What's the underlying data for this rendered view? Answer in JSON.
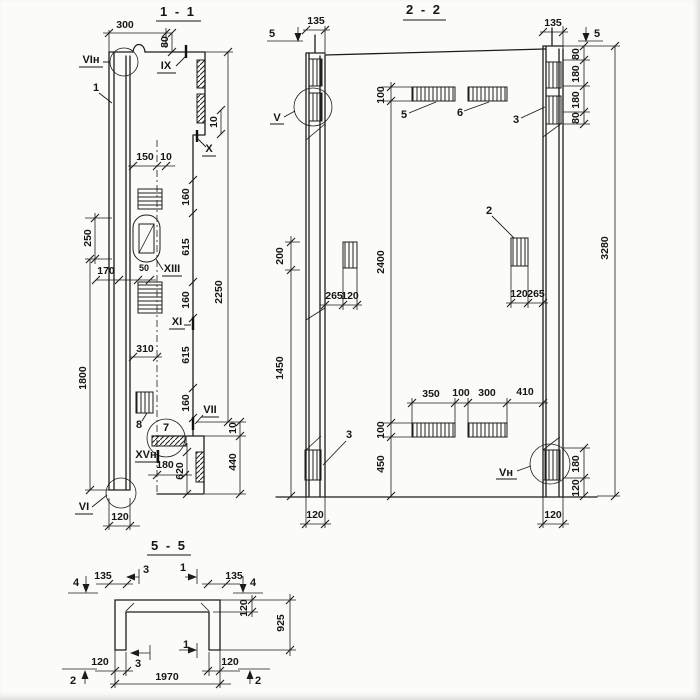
{
  "s11": {
    "title": "1 - 1",
    "dims": {
      "d300": "300",
      "d80": "80",
      "d150": "150",
      "d10a": "10",
      "d10b": "10",
      "d10c": "10",
      "d160a": "160",
      "d615a": "615",
      "d160b": "160",
      "d615b": "615",
      "d160c": "160",
      "d2250": "2250",
      "d250": "250",
      "d170": "170",
      "d50": "50",
      "d310": "310",
      "d1800": "1800",
      "d180": "180",
      "d620": "620",
      "d440": "440",
      "d120": "120"
    },
    "marks": {
      "vi_n": "VIн",
      "one": "1",
      "ix": "IX",
      "x": "X",
      "xiii": "XIII",
      "xi": "XI",
      "vii": "VII",
      "xv_n": "XVн",
      "vi": "VI",
      "seven": "7",
      "eight": "8"
    }
  },
  "s22": {
    "title": "2 - 2",
    "dims": {
      "d135l": "135",
      "d135r": "135",
      "d100t": "100",
      "d2400": "2400",
      "d100b": "100",
      "d450": "450",
      "d200": "200",
      "d1450": "1450",
      "d265l": "265",
      "d120l": "120",
      "d120r": "120",
      "d265r": "265",
      "d350": "350",
      "d100m": "100",
      "d300": "300",
      "d410": "410",
      "d3280": "3280",
      "d80a": "80",
      "d180a": "180",
      "d180b": "180",
      "d80b": "80",
      "d180c": "180",
      "d120c": "120",
      "d120bl": "120",
      "d120br": "120"
    },
    "marks": {
      "cut5l": "5",
      "cut5r": "5",
      "v": "V",
      "vn": "Vн",
      "p2": "2",
      "p3t": "3",
      "p3b": "3",
      "p5": "5",
      "p6": "6"
    }
  },
  "s55": {
    "title": "5 - 5",
    "dims": {
      "d135l": "135",
      "d135r": "135",
      "d120t": "120",
      "d925": "925",
      "d120bl": "120",
      "d120br": "120",
      "d1970": "1970"
    },
    "marks": {
      "b3t": "3",
      "b1t": "1",
      "c4l": "4",
      "c4r": "4",
      "b3b": "3",
      "b1b": "1",
      "c2l": "2",
      "c2r": "2"
    }
  }
}
